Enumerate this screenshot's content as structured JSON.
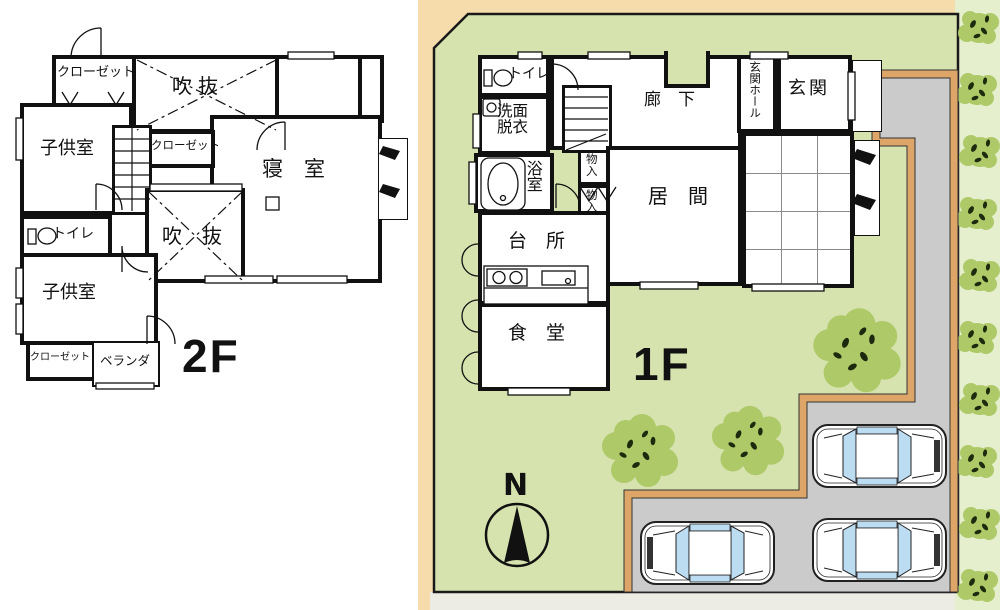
{
  "title": "House floor plan with site plan (2F / 1F)",
  "floor2": {
    "label": "2F",
    "rooms": {
      "closet_tl": "クローゼット",
      "void_top": "吹抜",
      "child_top": "子供室",
      "closet_mid": "クローゼット",
      "bedroom": "寝　室",
      "void_mid": "吹　抜",
      "toilet": "トイレ",
      "child_bottom": "子供室",
      "closet_b": "クローゼット",
      "veranda": "ベランダ"
    }
  },
  "floor1": {
    "label": "1F",
    "rooms": {
      "toilet": "トイレ",
      "washroom": "洗面脱衣",
      "bath": "浴室",
      "corridor": "廊　下",
      "storage1": "物入",
      "storage2": "物入",
      "hall": "玄関ホール",
      "entrance": "玄関",
      "living": "居　間",
      "kitchen": "台　所",
      "dining": "食　堂"
    }
  },
  "compass": {
    "north": "N"
  },
  "colors": {
    "site_green": "#d6e3ae",
    "hedge_bg": "#e6efcd",
    "tree_green": "#aec968",
    "tree_dot": "#1d2a0e",
    "path_gray": "#cbcbcb",
    "curb_tan": "#dda568",
    "margin_peach": "#f7dcab",
    "road_strip": "#edece4",
    "window_blue": "#bcdcf2",
    "line": "#111111"
  },
  "icons": {
    "north_arrow": "filled-triangle-compass",
    "toilet": "toilet-plan-icon",
    "bathtub": "bathtub-plan-icon",
    "stove": "two-burner-stove-icon",
    "sink": "kitchen-sink-icon",
    "car": "car-top-view-icon",
    "tree": "garden-tree-icon",
    "hedge": "hedge-shrub-icon"
  }
}
